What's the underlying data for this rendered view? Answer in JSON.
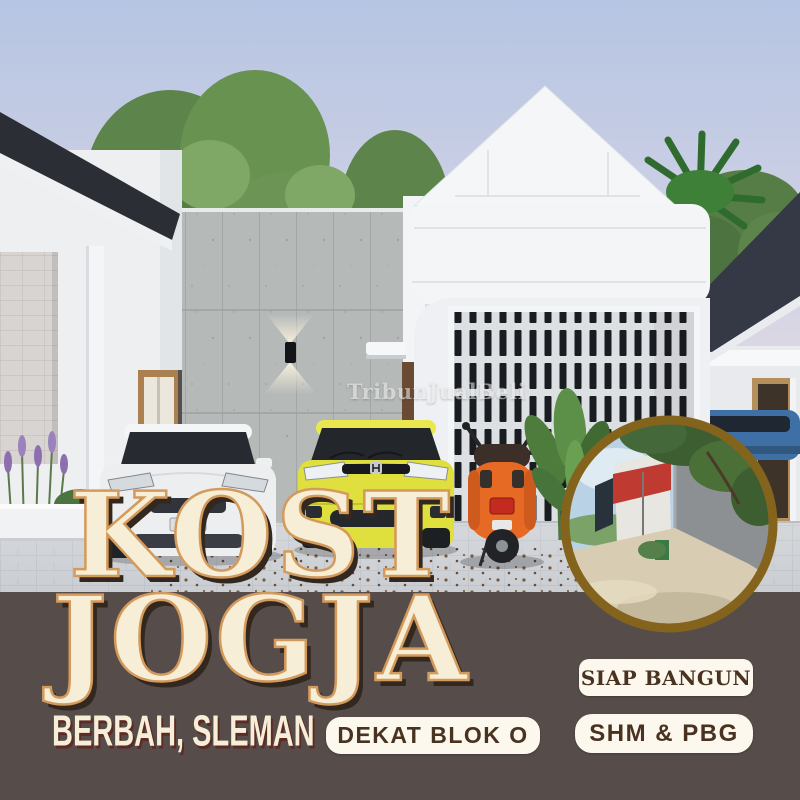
{
  "poster": {
    "title_line1": "KOST",
    "title_line2": "JOGJA",
    "location": "BERBAH, SLEMAN",
    "watermark": "TribunJualBeli",
    "badges": [
      {
        "id": "dekat-blok-o",
        "label": "DEKAT BLOK O"
      },
      {
        "id": "siap-bangun",
        "label": "SIAP BANGUN"
      },
      {
        "id": "shm-pbg",
        "label": "SHM & PBG"
      }
    ],
    "colors": {
      "matte": "#564d4a",
      "title_fill": "#f6eed6",
      "title_outline": "#d49a5c",
      "title_shadow": "#33281f",
      "badge_bg": "#fcf8ee",
      "badge_text": "#49321f",
      "location_text": "#f6eed6",
      "location_shadow": "#5d2b27",
      "inset_ring": "#84641c"
    },
    "scene_objects": [
      "dusk-sky",
      "trees",
      "left-neighbor-house",
      "stone-tile-wall",
      "wall-sconce-light",
      "entry-door",
      "main-house-gable",
      "breeze-block-screen",
      "palm-tree",
      "right-neighbor-house",
      "blue-suv",
      "white-sedan",
      "yellow-hatchback",
      "orange-scooter",
      "banana-plant",
      "lavender-plants",
      "paved-driveway",
      "street-photo-inset"
    ]
  }
}
